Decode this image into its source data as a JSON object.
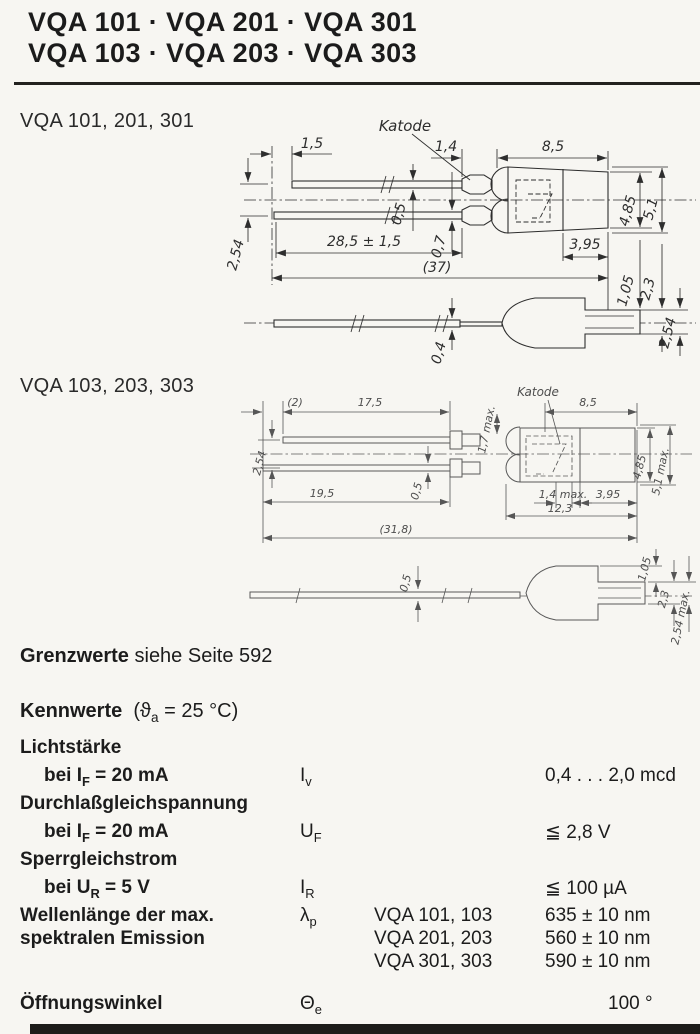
{
  "header": {
    "title_line1": "VQA 101 · VQA 201 · VQA 301",
    "title_line2": "VQA 103 · VQA 203 · VQA 303"
  },
  "d1": {
    "label": "VQA 101, 201, 301",
    "katode": "Katode",
    "dim_1_5": "1,5",
    "dim_1_4": "1,4",
    "dim_8_5": "8,5",
    "dim_2_54_pitch": "2,54",
    "dim_0_5": "0,5",
    "dim_0_7": "0,7",
    "dim_28_5": "28,5 ± 1,5",
    "dim_37": "(37)",
    "dim_4_85": "4,85",
    "dim_5_1": "5,1",
    "dim_3_95": "3,95",
    "dim_1_05": "1,05",
    "dim_2_3": "2,3",
    "dim_2_54_side": "2,54",
    "dim_0_4": "0,4"
  },
  "d2": {
    "label": "VQA 103, 203, 303",
    "katode": "Katode",
    "dim_2": "(2)",
    "dim_17_5": "17,5",
    "dim_1_7": "1,7 max.",
    "dim_8_5": "8,5",
    "dim_2_54_pitch": "2,54",
    "dim_19_5": "19,5",
    "dim_0_5_top": "0,5",
    "dim_1_4": "1,4 max.",
    "dim_3_95": "3,95",
    "dim_12_3": "12,3",
    "dim_31_8": "(31,8)",
    "dim_4_85": "4,85",
    "dim_5_1": "5,1 max.",
    "dim_0_5_side": "0,5",
    "dim_1_05": "1,05",
    "dim_2_3": "2,3",
    "dim_2_54_max": "2,54 max."
  },
  "grenzwerte": {
    "bold": "Grenzwerte",
    "rest": " siehe Seite 592"
  },
  "kennwerte": {
    "heading": {
      "bold": "Kennwerte",
      "cond_pre": "(ϑ",
      "cond_sub": "a",
      "cond_post": " = 25 °C)"
    },
    "lichtstaerke": {
      "label": "Lichtstärke",
      "cond_pre": "bei I",
      "cond_sub": "F",
      "cond_post": " = 20 mA",
      "sym": "I",
      "sym_sub": "v",
      "value": "0,4 . . . 2,0 mcd"
    },
    "durchlass": {
      "label": "Durchlaßgleichspannung",
      "cond_pre": "bei I",
      "cond_sub": "F",
      "cond_post": " = 20 mA",
      "sym": "U",
      "sym_sub": "F",
      "value": "≦ 2,8 V"
    },
    "sperr": {
      "label": "Sperrgleichstrom",
      "cond_pre": "bei U",
      "cond_sub": "R",
      "cond_post": " = 5 V",
      "sym": "I",
      "sym_sub": "R",
      "value": "≦ 100 µA"
    },
    "wellenlaenge": {
      "label1": "Wellenlänge der max.",
      "label2": "spektralen Emission",
      "sym": "λ",
      "sym_sub": "p",
      "entries": [
        {
          "device": "VQA 101, 103",
          "value": "635 ± 10 nm"
        },
        {
          "device": "VQA 201, 203",
          "value": "560 ± 10 nm"
        },
        {
          "device": "VQA 301, 303",
          "value": "590 ± 10 nm"
        }
      ]
    },
    "oeffnung": {
      "label": "Öffnungswinkel",
      "sym": "Θ",
      "sym_sub": "e",
      "value": "100 °"
    }
  }
}
